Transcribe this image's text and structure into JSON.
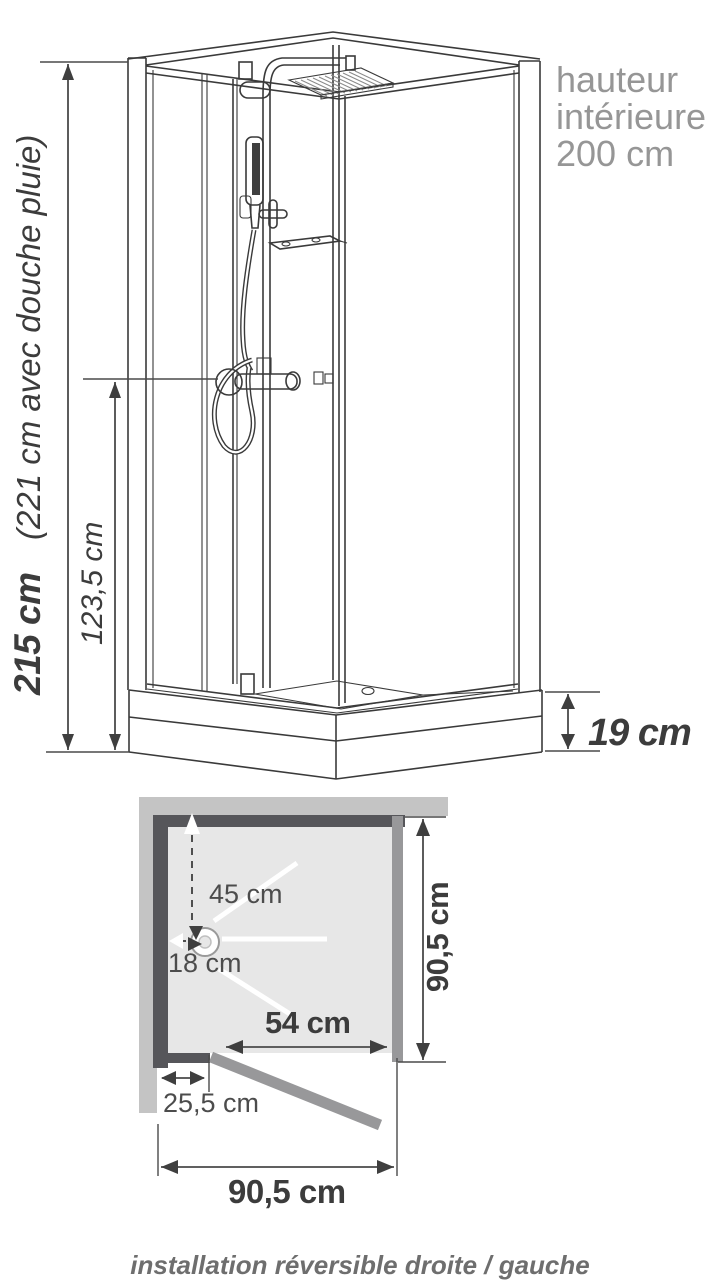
{
  "colors": {
    "line": "#3a3a3a",
    "dim": "#4a4a4a",
    "label_dark": "#3c3c3c",
    "label_gray": "#969696",
    "caption_gray": "#6e6e6e",
    "wall_dark": "#56565a",
    "wall_light": "#c4c4c4",
    "tray_fill": "#e7e7e7",
    "glass_gray": "#98989a",
    "head_fill": "#3f3f3f"
  },
  "elevation": {
    "total_height": "215 cm",
    "total_height_note": "(221 cm avec douche pluie)",
    "mixer_height": "123,5 cm",
    "interior_height_lines": [
      "hauteur",
      "intérieure",
      "200 cm"
    ],
    "tray_height": "19 cm"
  },
  "plan": {
    "drain_offset_back": "45 cm",
    "drain_offset_side": "18 cm",
    "door_width": "54 cm",
    "inner_depth": "90,5 cm",
    "hinge_offset": "25,5 cm",
    "outer_width": "90,5 cm"
  },
  "caption": "installation réversible droite / gauche"
}
